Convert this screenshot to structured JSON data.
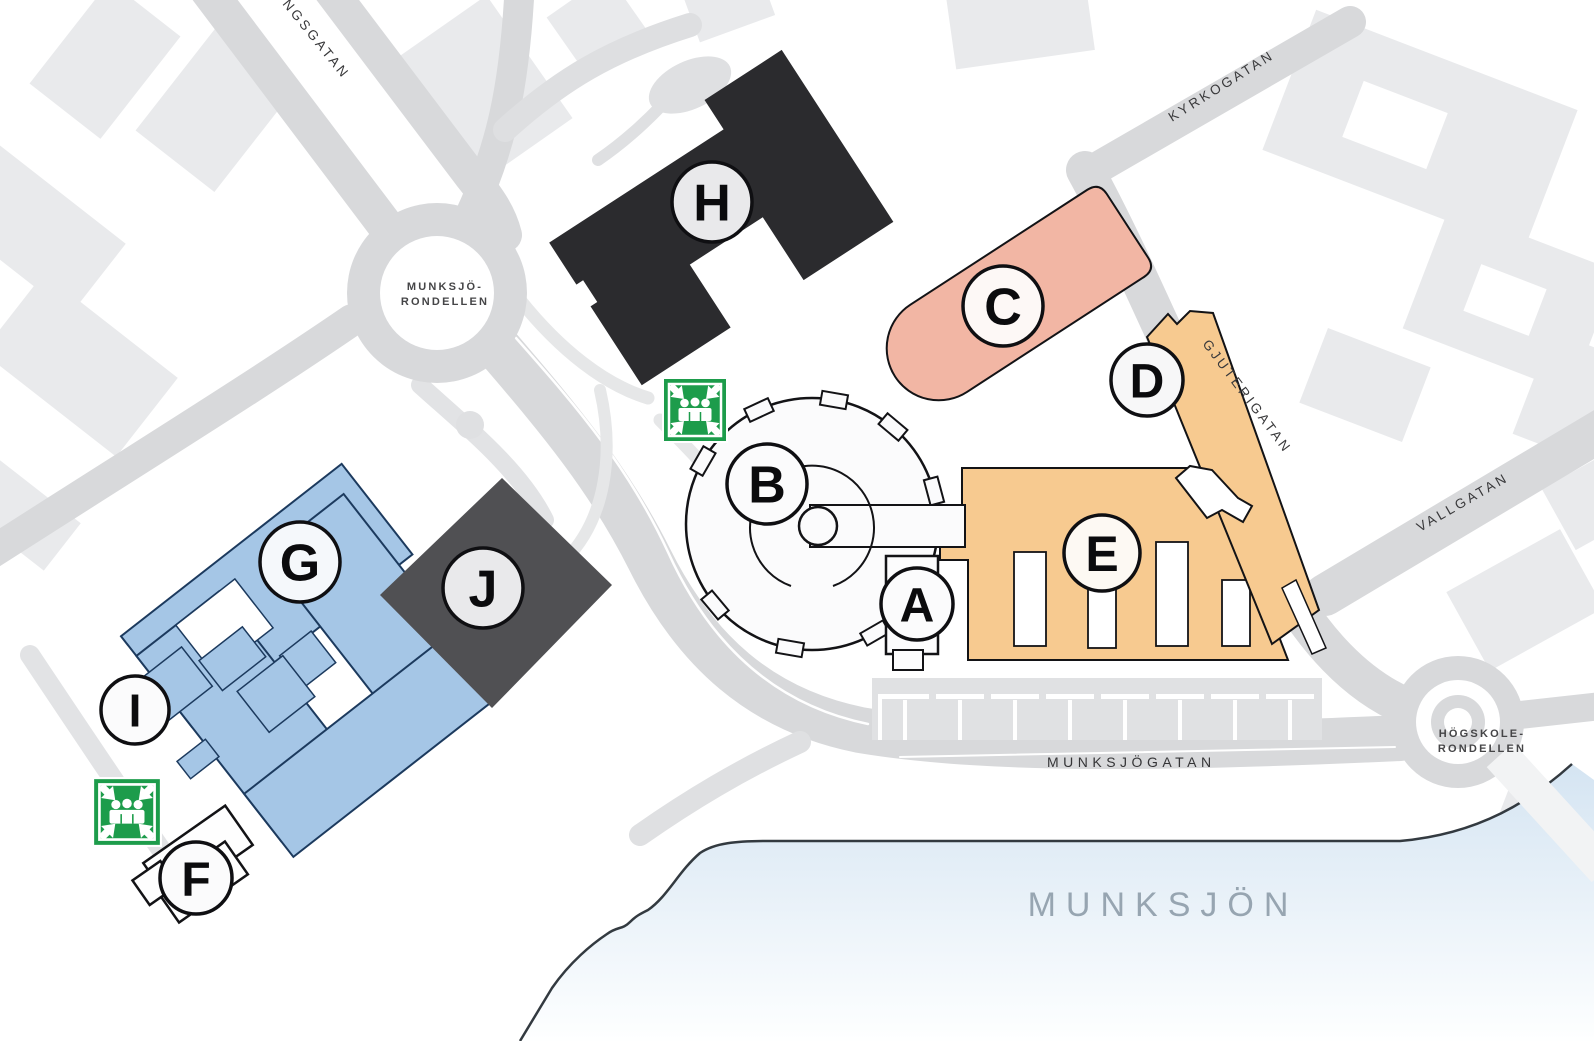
{
  "streets": {
    "ngsgatan": "NGSGATAN",
    "kyrkogatan": "KYRKOGATAN",
    "gjuterigatan": "GJUTERIGATAN",
    "vallgatan": "VALLGATAN",
    "munksjogatan": "MUNKSJÖGATAN"
  },
  "roundabouts": {
    "munksjo": {
      "line1": "MUNKSJÖ-",
      "line2": "RONDELLEN"
    },
    "hogskole": {
      "line1": "HÖGSKOLE-",
      "line2": "RONDELLEN"
    }
  },
  "lake": {
    "name": "MUNKSJÖN"
  },
  "buildings": {
    "a": "A",
    "b": "B",
    "c": "C",
    "d": "D",
    "e": "E",
    "f": "F",
    "g": "G",
    "h": "H",
    "i": "I",
    "j": "J"
  },
  "icons": {
    "assembly_point": "assembly-point"
  },
  "colors": {
    "building_dark": "#2B2B2E",
    "building_gray": "#505053",
    "building_blue": "#A5C6E6",
    "building_blue_outline": "#1C3A5E",
    "building_orange": "#F7CA90",
    "building_salmon": "#F2B6A4",
    "building_white": "#FBFBFC",
    "assembly_green": "#1D9C4B",
    "road_gray": "#D8D9DB",
    "context_building_gray": "#E9EAEC",
    "lake_blue": "#D4E4F2"
  }
}
